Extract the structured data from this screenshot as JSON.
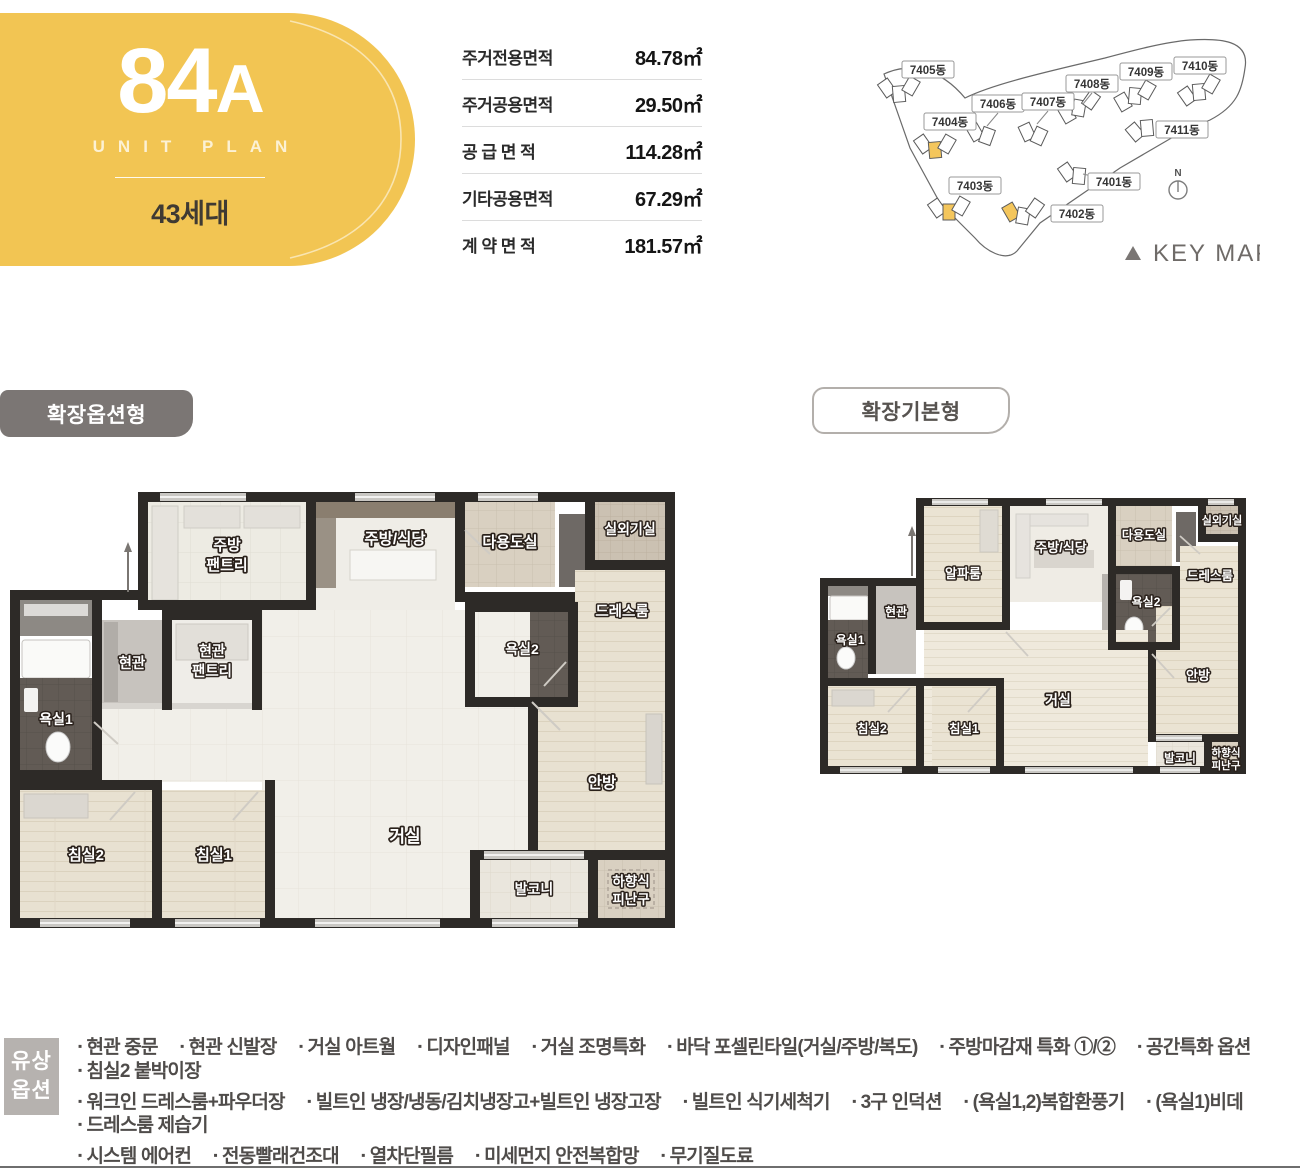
{
  "unit_badge": {
    "number": "84",
    "variant": "A",
    "subtitle": "UNIT PLAN",
    "households": "43세대"
  },
  "area_table": {
    "rows": [
      {
        "label": "주거전용면적",
        "value": "84.78㎡"
      },
      {
        "label": "주거공용면적",
        "value": "29.50㎡"
      },
      {
        "label": "공 급 면 적",
        "value": "114.28㎡"
      },
      {
        "label": "기타공용면적",
        "value": "67.29㎡"
      },
      {
        "label": "계 약 면 적",
        "value": "181.57㎡"
      }
    ]
  },
  "key_map": {
    "caption": "KEY MAP",
    "compass": "N",
    "buildings": [
      "7405동",
      "7406동",
      "7407동",
      "7408동",
      "7409동",
      "7410동",
      "7411동",
      "7404동",
      "7403동",
      "7401동",
      "7402동"
    ]
  },
  "section_tabs": {
    "expanded_option": "확장옵션형",
    "expanded_basic": "확장기본형"
  },
  "floorplan_left": {
    "rooms": {
      "kitchen_pantry_1": "주방",
      "kitchen_pantry_2": "팬트리",
      "kitchen_dining": "주방/식당",
      "utility": "다용도실",
      "outdoor_unit": "실외기실",
      "dress_room": "드레스룸",
      "bath2": "욕실2",
      "entry": "현관",
      "entry_pantry_1": "현관",
      "entry_pantry_2": "팬트리",
      "bath1": "욕실1",
      "bedroom2": "침실2",
      "bedroom1": "침실1",
      "living": "거실",
      "master": "안방",
      "balcony": "발코니",
      "escape_1": "하향식",
      "escape_2": "피난구"
    }
  },
  "floorplan_right": {
    "rooms": {
      "alpha": "알파룸",
      "kitchen_dining": "주방/식당",
      "utility": "다용도실",
      "outdoor_unit": "실외기실",
      "dress_room": "드레스룸",
      "bath2": "욕실2",
      "entry": "현관",
      "bath1": "욕실1",
      "bedroom2": "침실2",
      "bedroom1": "침실1",
      "living": "거실",
      "master": "안방",
      "balcony": "발코니",
      "escape_1": "하향식",
      "escape_2": "피난구"
    }
  },
  "options": {
    "heading_1": "유상",
    "heading_2": "옵션",
    "bullet": "▪",
    "lines": [
      [
        "현관 중문",
        "현관 신발장",
        "거실 아트월",
        "디자인패널",
        "거실 조명특화",
        "바닥 포셀린타일(거실/주방/복도)",
        "주방마감재 특화 ①/②",
        "공간특화 옵션",
        "침실2 붙박이장"
      ],
      [
        "워크인 드레스룸+파우더장",
        "빌트인 냉장/냉동/김치냉장고+빌트인 냉장고장",
        "빌트인 식기세척기",
        "3구 인덕션",
        "(욕실1,2)복합환풍기",
        "(욕실1)비데",
        "드레스룸 제습기"
      ],
      [
        "시스템 에어컨",
        "전동빨래건조대",
        "열차단필름",
        "미세먼지 안전복합망",
        "무기질도료"
      ]
    ]
  }
}
